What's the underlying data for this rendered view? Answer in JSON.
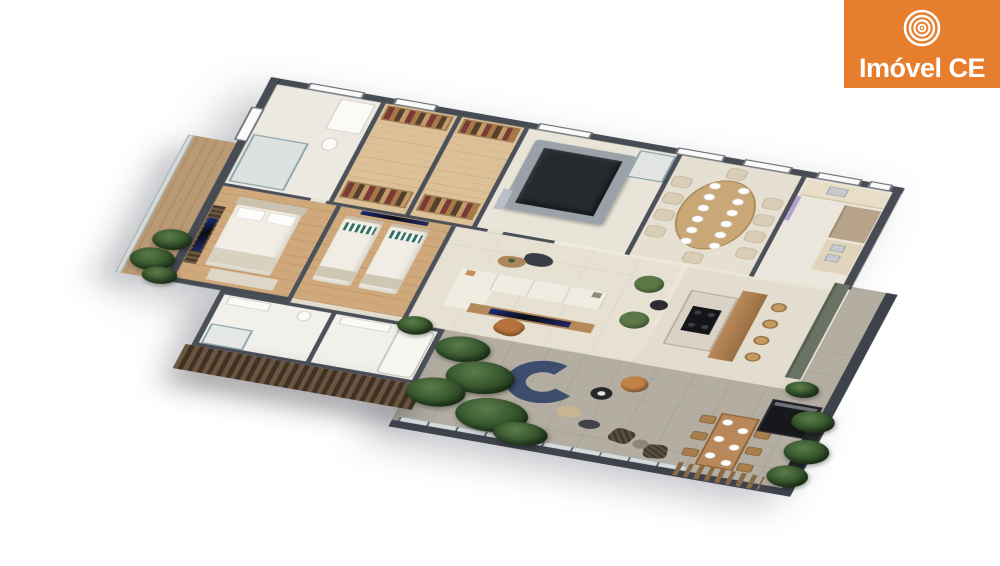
{
  "page": {
    "background": "#FFFFFF"
  },
  "brand": {
    "label": "Imóvel CE",
    "icon": "concentric-circles-icon",
    "colors": {
      "background": "#E67E2D",
      "text": "#FFFFFF"
    }
  },
  "scene": {
    "kind": "isometric-3d-floorplan-render",
    "regions": [
      "master-bathroom",
      "walk-in-closet-1",
      "walk-in-closet-2",
      "spa-hot-tub",
      "hallway-shower",
      "dining-room",
      "kitchen",
      "master-bedroom",
      "bedroom-2",
      "bathroom-1",
      "bathroom-2",
      "living-room",
      "kitchen-island-bar",
      "side-balcony",
      "terrace",
      "outdoor-dining",
      "outdoor-grill",
      "planters",
      "slatted-facade"
    ],
    "palette": {
      "wall": "#464B54",
      "floor_cream": "#E9E3D6",
      "floor_wood": "#CFA87B",
      "terrace_stone": "#B4AEA2",
      "hot_tub": "#26292E",
      "sofa_navy": "#3C4D6D",
      "armchair_tan": "#C28347",
      "armchair_green": "#5D7847",
      "plant_green": "#2E4A2B",
      "wood_furniture": "#B8885A",
      "slat_screen": "#6B5540"
    }
  }
}
